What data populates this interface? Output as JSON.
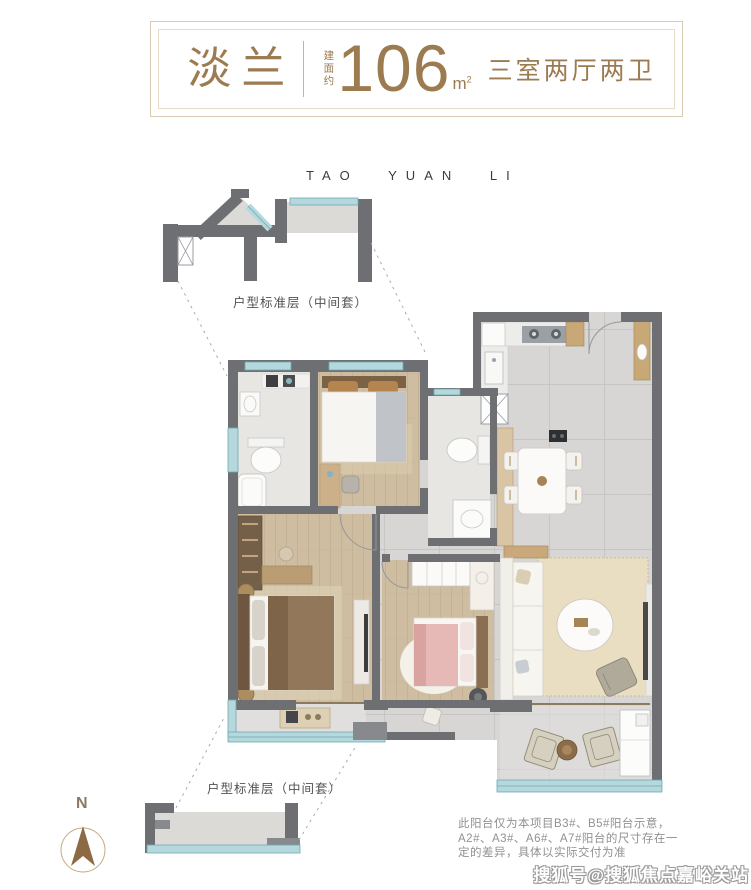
{
  "header": {
    "title": "淡兰",
    "area_prefix": "建面约",
    "area_value": "106",
    "area_unit": "m",
    "area_unit_sup": "2",
    "layout": "三室两厅两卫"
  },
  "plan": {
    "project_name": "TAO YUAN LI",
    "floor_label_top": "户型标准层（中间套）",
    "floor_label_bottom": "户型标准层（中间套）",
    "compass_label": "N"
  },
  "footer": {
    "disclaimer_line1": "此阳台仅为本项目B3#、B5#阳台示意，",
    "disclaimer_line2": "A2#、A3#、A6#、A7#阳台的尺寸存在一",
    "disclaimer_line3": "定的差异，具体以实际交付为准",
    "watermark": "搜狐号@搜狐焦点嘉峪关站"
  },
  "colors": {
    "accent_gold": "#9c7b50",
    "border_beige": "#d9cab4",
    "wall_gray": "#6d6f72",
    "window_teal": "#b5d8dd",
    "window_teal_line": "#6fa9b4",
    "wood_floor": "#cfbda2",
    "tile_gray": "#d7d6d4"
  }
}
